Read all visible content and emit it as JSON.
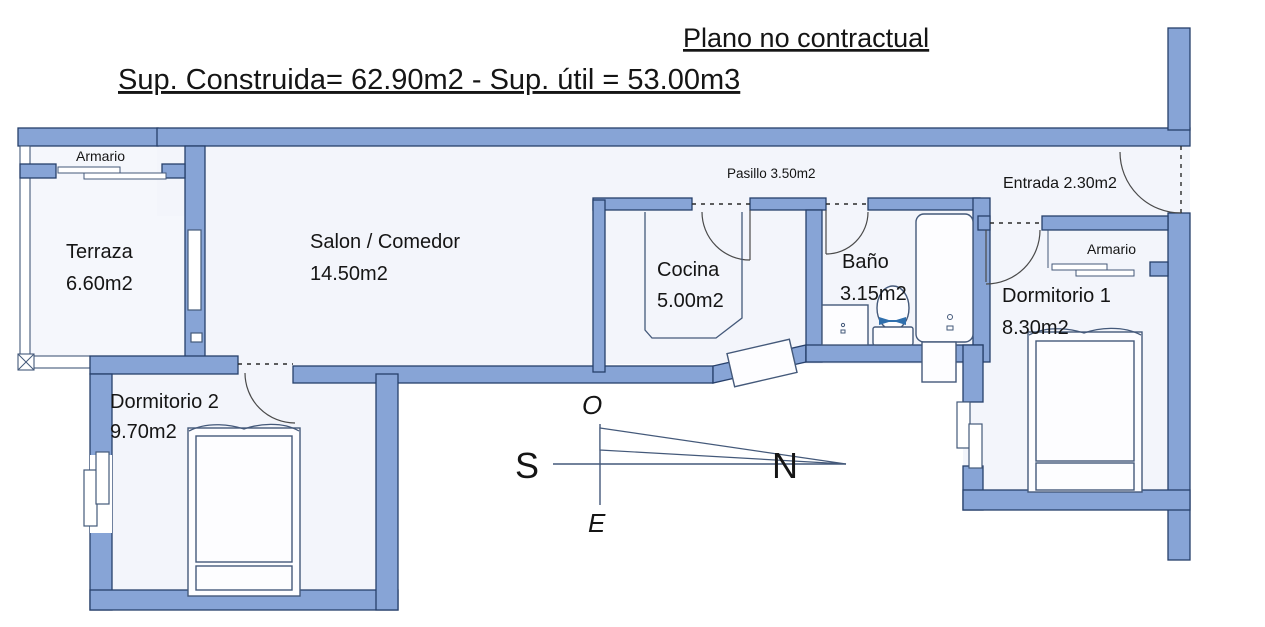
{
  "header": {
    "title": "Plano no contractual",
    "subtitle": "Sup. Construida= 62.90m2 - Sup. útil = 53.00m3"
  },
  "rooms": {
    "terraza": {
      "name": "Terraza",
      "area": "6.60m2"
    },
    "armario_terraza": {
      "name": "Armario"
    },
    "salon": {
      "name": "Salon / Comedor",
      "area": "14.50m2"
    },
    "pasillo": {
      "label": "Pasillo 3.50m2"
    },
    "entrada": {
      "label": "Entrada 2.30m2"
    },
    "cocina": {
      "name": "Cocina",
      "area": "5.00m2"
    },
    "bano": {
      "name": "Baño",
      "area": "3.15m2"
    },
    "armario_dorm1": {
      "name": "Armario"
    },
    "dormitorio1": {
      "name": "Dormitorio 1",
      "area": "8.30m2"
    },
    "dormitorio2": {
      "name": "Dormitorio 2",
      "area": "9.70m2"
    }
  },
  "compass": {
    "north": "N",
    "south": "S",
    "east": "E",
    "west": "O"
  },
  "colors": {
    "wall": "#87a4d6",
    "wall_outline": "#27406b",
    "floor": "#f3f5fb",
    "terrace_floor": "#f5f7fc",
    "line": "#44597a",
    "text": "#151515",
    "compass": "#44597a"
  }
}
